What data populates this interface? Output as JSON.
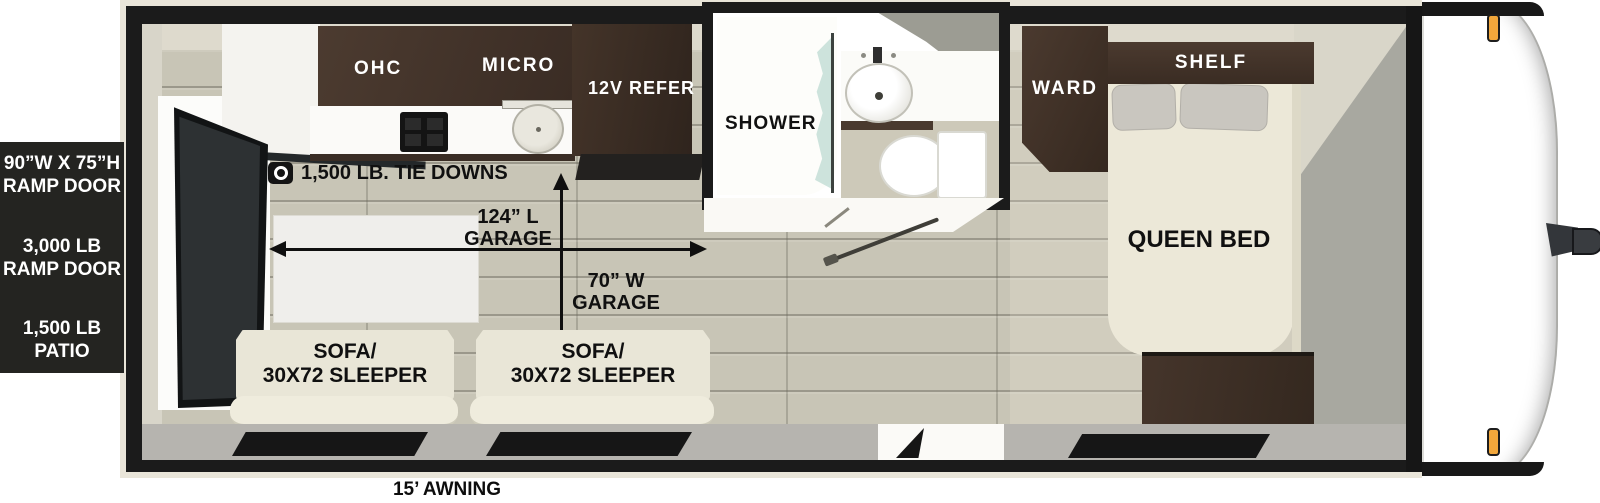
{
  "spec_panel": {
    "items": [
      {
        "line1": "90”W X 75”H",
        "line2": "RAMP DOOR"
      },
      {
        "line1": "3,000 LB",
        "line2": "RAMP DOOR"
      },
      {
        "line1": "1,500 LB",
        "line2": "PATIO"
      }
    ]
  },
  "kitchen": {
    "ohc_label": "OHC",
    "micro_label": "MICRO",
    "refer_label": "12V REFER"
  },
  "garage": {
    "tie_down_label": "1,500 LB. TIE DOWNS",
    "length_line1": "124” L",
    "length_line2": "GARAGE",
    "width_line1": "70” W",
    "width_line2": "GARAGE"
  },
  "bathroom": {
    "shower_label": "SHOWER"
  },
  "bedroom": {
    "ward_label": "WARD",
    "shelf_label": "SHELF",
    "bed_label": "QUEEN BED"
  },
  "seating": {
    "sofas": [
      {
        "line1": "SOFA/",
        "line2": "30X72 SLEEPER"
      },
      {
        "line1": "SOFA/",
        "line2": "30X72 SLEEPER"
      }
    ]
  },
  "exterior": {
    "awning_label": "15’ AWNING"
  },
  "colors": {
    "wall_black": "#1b1b1b",
    "cabinet_brown": "#453629",
    "floor_plank": "#c8c5b6",
    "sofa_cream": "#e9e6d7",
    "panel_bg": "#242421",
    "marker_amber": "#f2a73b"
  }
}
